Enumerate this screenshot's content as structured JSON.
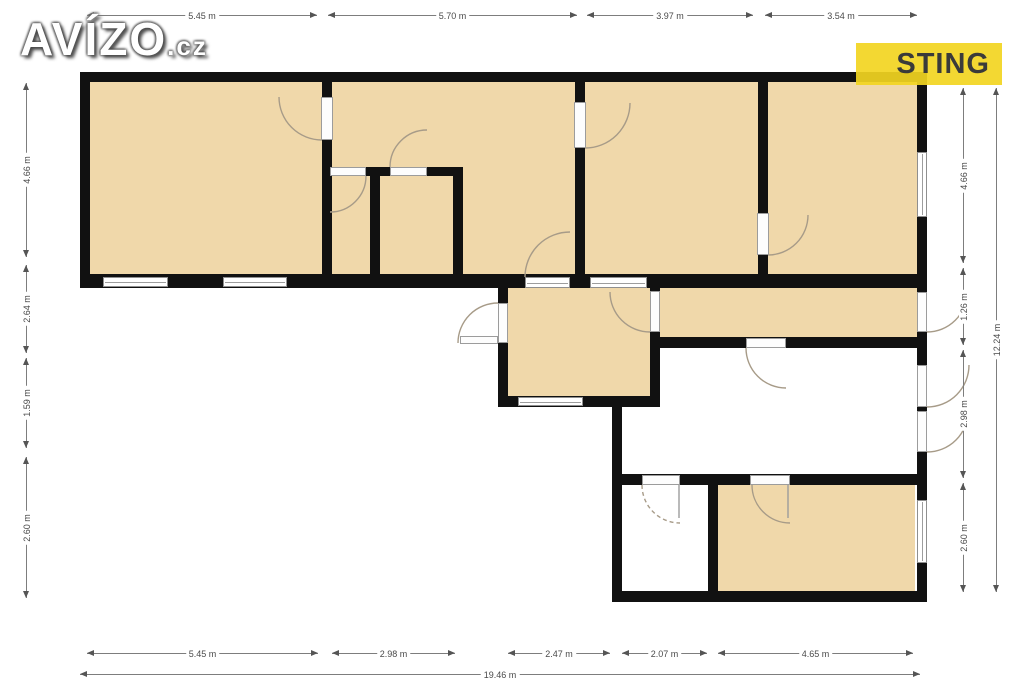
{
  "branding": {
    "avizo_text": "AVÍZO",
    "avizo_suffix": ".cz",
    "sting_text": "STING",
    "sting_bg": "rgba(242,213,33,0.92)",
    "sting_fg": "#3a3a3a"
  },
  "palette": {
    "wall": "#111111",
    "room_fill": "#f0d8aa",
    "arc": "#a79b88",
    "dim": "#4a4a4a"
  },
  "floorplan": {
    "fills": [
      [
        90,
        82,
        232,
        192
      ],
      [
        332,
        82,
        243,
        192
      ],
      [
        585,
        82,
        173,
        192
      ],
      [
        768,
        82,
        149,
        192
      ],
      [
        508,
        288,
        142,
        108
      ],
      [
        660,
        288,
        257,
        49
      ],
      [
        718,
        485,
        197,
        106
      ]
    ],
    "walls": [
      [
        80,
        72,
        847,
        10
      ],
      [
        80,
        274,
        847,
        14
      ],
      [
        322,
        167,
        141,
        9
      ],
      [
        498,
        396,
        162,
        11
      ],
      [
        652,
        337,
        275,
        11
      ],
      [
        612,
        474,
        305,
        11
      ],
      [
        612,
        591,
        315,
        11
      ],
      [
        80,
        72,
        10,
        216
      ],
      [
        322,
        72,
        10,
        216
      ],
      [
        575,
        72,
        10,
        216
      ],
      [
        758,
        72,
        10,
        216
      ],
      [
        917,
        72,
        10,
        530
      ],
      [
        370,
        167,
        10,
        121
      ],
      [
        453,
        167,
        10,
        121
      ],
      [
        498,
        274,
        10,
        133
      ],
      [
        650,
        274,
        10,
        133
      ],
      [
        612,
        396,
        10,
        206
      ],
      [
        708,
        474,
        10,
        128
      ]
    ],
    "windows": [
      [
        103,
        277,
        65,
        10
      ],
      [
        223,
        277,
        64,
        10
      ],
      [
        917,
        152,
        10,
        65
      ],
      [
        518,
        397,
        65,
        9
      ],
      [
        917,
        500,
        10,
        63
      ],
      [
        525,
        277,
        45,
        11
      ],
      [
        590,
        277,
        57,
        11
      ]
    ],
    "doors": [
      [
        321,
        97,
        12,
        43
      ],
      [
        330,
        167,
        36,
        9
      ],
      [
        390,
        167,
        37,
        9
      ],
      [
        574,
        102,
        12,
        46
      ],
      [
        757,
        213,
        12,
        42
      ],
      [
        498,
        303,
        10,
        40
      ],
      [
        460,
        336,
        38,
        8
      ],
      [
        650,
        291,
        10,
        41
      ],
      [
        917,
        292,
        10,
        40
      ],
      [
        917,
        365,
        10,
        42
      ],
      [
        917,
        411,
        10,
        41
      ],
      [
        746,
        338,
        40,
        10
      ],
      [
        642,
        475,
        38,
        10
      ],
      [
        750,
        475,
        40,
        10
      ]
    ],
    "arcs": [
      {
        "d": "M279,97 A43,43 0 0 0 322,140"
      },
      {
        "d": "M366,176 A36,36 0 0 1 330,212"
      },
      {
        "d": "M390,167 A37,37 0 0 1 427,130"
      },
      {
        "d": "M630,103 A45,45 0 0 1 585,148"
      },
      {
        "d": "M808,215 A40,40 0 0 1 768,255"
      },
      {
        "d": "M525,277 A45,45 0 0 1 570,232"
      },
      {
        "d": "M498,303 A40,40 0 0 0 458,343"
      },
      {
        "d": "M610,292 A40,40 0 0 0 650,332"
      },
      {
        "d": "M967,292 A40,40 0 0 1 927,332"
      },
      {
        "d": "M969,365 A42,42 0 0 1 927,407"
      },
      {
        "d": "M968,411 A41,41 0 0 1 927,452"
      },
      {
        "d": "M746,348 A40,40 0 0 0 786,388"
      },
      {
        "d": "M642,485 A38,38 0 0 0 680,523",
        "dashed": true
      },
      {
        "d": "M752,485 A38,38 0 0 0 790,523"
      }
    ],
    "leaves": [
      [
        679,
        485,
        679,
        518
      ],
      [
        788,
        485,
        788,
        518
      ]
    ]
  },
  "dimensions": {
    "h": [
      {
        "label": "5.45 m",
        "x1": 87,
        "x2": 317,
        "y": 15
      },
      {
        "label": "5.70 m",
        "x1": 328,
        "x2": 577,
        "y": 15
      },
      {
        "label": "3.97 m",
        "x1": 587,
        "x2": 753,
        "y": 15
      },
      {
        "label": "3.54 m",
        "x1": 765,
        "x2": 917,
        "y": 15
      },
      {
        "label": "5.45 m",
        "x1": 87,
        "x2": 318,
        "y": 653
      },
      {
        "label": "2.98 m",
        "x1": 332,
        "x2": 455,
        "y": 653
      },
      {
        "label": "2.47 m",
        "x1": 508,
        "x2": 610,
        "y": 653
      },
      {
        "label": "2.07 m",
        "x1": 622,
        "x2": 707,
        "y": 653
      },
      {
        "label": "4.65 m",
        "x1": 718,
        "x2": 913,
        "y": 653
      },
      {
        "label": "19.46 m",
        "x1": 80,
        "x2": 920,
        "y": 674
      }
    ],
    "v": [
      {
        "label": "4.66 m",
        "y1": 83,
        "y2": 257,
        "x": 26
      },
      {
        "label": "2.64 m",
        "y1": 265,
        "y2": 353,
        "x": 26
      },
      {
        "label": "1.59 m",
        "y1": 358,
        "y2": 448,
        "x": 26
      },
      {
        "label": "2.60 m",
        "y1": 457,
        "y2": 598,
        "x": 26
      },
      {
        "label": "4.66 m",
        "y1": 88,
        "y2": 263,
        "x": 963
      },
      {
        "label": "1.26 m",
        "y1": 268,
        "y2": 345,
        "x": 963
      },
      {
        "label": "2.98 m",
        "y1": 350,
        "y2": 478,
        "x": 963
      },
      {
        "label": "2.60 m",
        "y1": 483,
        "y2": 592,
        "x": 963
      },
      {
        "label": "12.24 m",
        "y1": 88,
        "y2": 592,
        "x": 996
      }
    ]
  }
}
